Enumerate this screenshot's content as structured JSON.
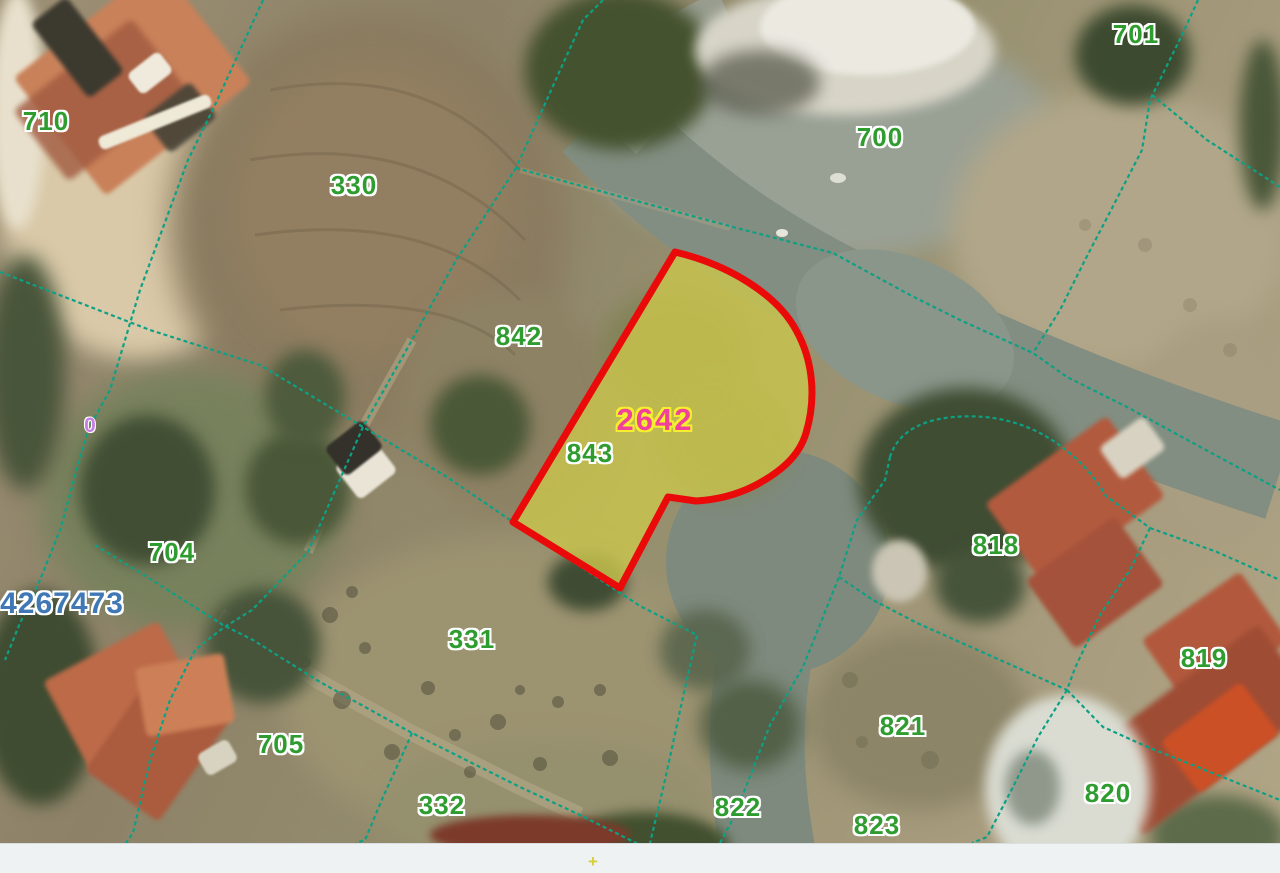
{
  "title": "Cadastral parcel map over satellite imagery",
  "map": {
    "colors": {
      "boundary": "#0ca184",
      "parcel_label": "#2f9c2f",
      "highlight_fill": "#c9c44d",
      "highlight_outline": "#ea0a0a",
      "highlight_label": "#f2419b",
      "highlight_halo": "#f6ef2e",
      "reference": "#3f78b5",
      "zero": "#c77fe4",
      "footer_bg": "#eff2f3"
    },
    "parcel_labels": [
      {
        "text": "710",
        "x": 46,
        "y": 121
      },
      {
        "text": "330",
        "x": 354,
        "y": 185
      },
      {
        "text": "700",
        "x": 880,
        "y": 137
      },
      {
        "text": "701",
        "x": 1136,
        "y": 34
      },
      {
        "text": "842",
        "x": 519,
        "y": 336
      },
      {
        "text": "843",
        "x": 590,
        "y": 453
      },
      {
        "text": "704",
        "x": 172,
        "y": 552
      },
      {
        "text": "705",
        "x": 281,
        "y": 744
      },
      {
        "text": "331",
        "x": 472,
        "y": 639
      },
      {
        "text": "332",
        "x": 442,
        "y": 805
      },
      {
        "text": "818",
        "x": 996,
        "y": 545
      },
      {
        "text": "819",
        "x": 1204,
        "y": 658
      },
      {
        "text": "820",
        "x": 1108,
        "y": 793
      },
      {
        "text": "821",
        "x": 903,
        "y": 726
      },
      {
        "text": "822",
        "x": 738,
        "y": 807
      },
      {
        "text": "823",
        "x": 877,
        "y": 825
      }
    ],
    "highlighted_parcel": {
      "label": "2642",
      "x": 655,
      "y": 420
    },
    "reference_number": {
      "text": "4267473",
      "x": 62,
      "y": 604
    },
    "zero_marker": {
      "text": "0",
      "x": 90,
      "y": 426
    }
  },
  "footer": {
    "marker": "+"
  }
}
